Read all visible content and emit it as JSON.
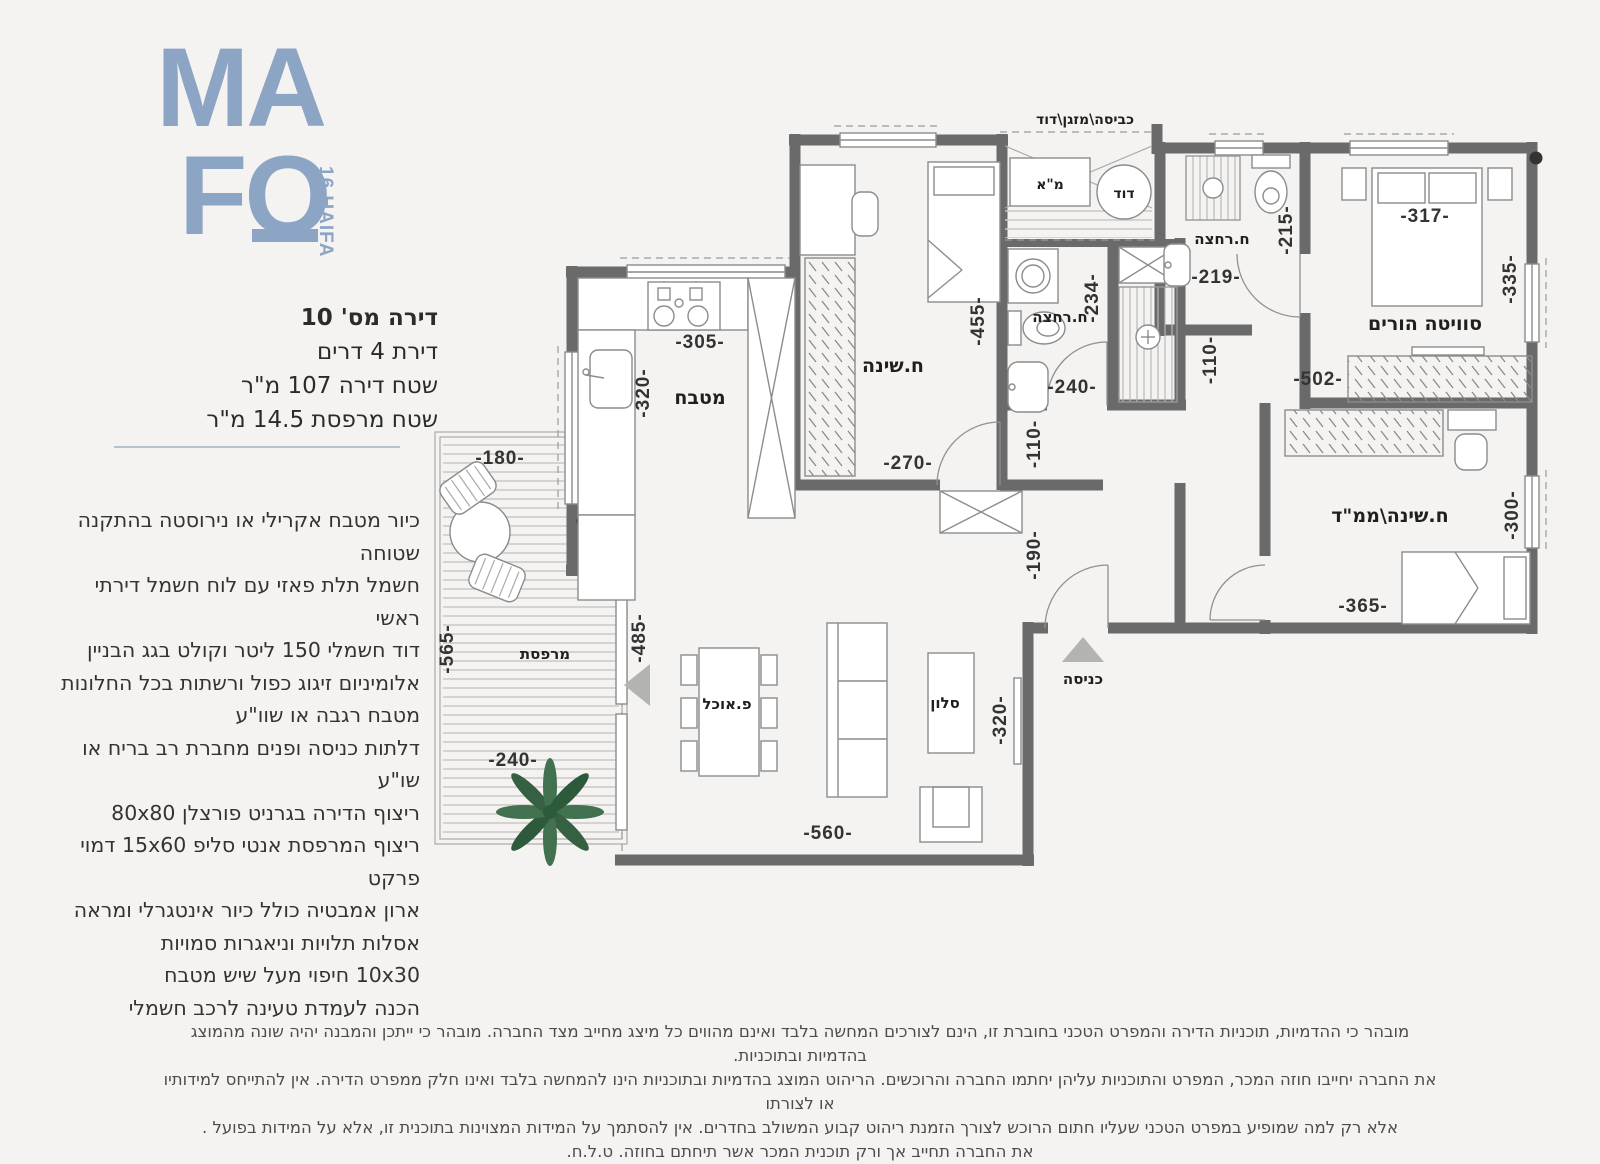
{
  "logo": {
    "line1": "MA",
    "line2": "FO",
    "tag": "16 HAIFA",
    "color": "#8da5c4"
  },
  "apartment": {
    "title": "דירה מס' 10",
    "line2": "דירת 4 דרים",
    "line3": "שטח דירה  107 מ\"ר",
    "line4": "שטח מרפסת 14.5 מ\"ר"
  },
  "specs": {
    "lines": [
      "כיור מטבח אקרילי או נירוסטה בהתקנה שטוחה",
      "חשמל תלת פאזי עם לוח חשמל דירתי ראשי",
      "דוד חשמלי 150 ליטר וקולט בגג הבניין",
      "אלומיניום זיגוג כפול ורשתות בכל החלונות",
      "מטבח רגבה או שוו\"ע",
      "דלתות כניסה ופנים מחברת רב בריח או שו\"ע",
      "ריצוף הדירה בגרניט פורצלן 80x80",
      "ריצוף המרפסת אנטי סליפ 15x60 דמוי פרקט",
      "ארון אמבטיה כולל כיור אינטגרלי ומראה",
      "אסלות תלויות וניאגרות סמויות",
      "10x30 חיפוי מעל שיש מטבח",
      "הכנה לעמדת טעינה לרכב חשמלי"
    ]
  },
  "plan": {
    "rooms": {
      "kitchen": "מטבח",
      "bedroom": "ח.שינה",
      "bath1": "ח.רחצה",
      "bath2": "ח.רחצה",
      "master": "סוויטה הורים",
      "mamad": "ח.שינה\\ממ\"ד",
      "salon": "סלון",
      "dining": "פ.אוכל",
      "balcony": "מרפסת",
      "entrance": "כניסה",
      "service": "כביסה\\מזגן\\דוד",
      "ma": "מ\"א",
      "dud": "דוד"
    },
    "dims": {
      "kitchen_w": "-305-",
      "kitchen_h": "-320-",
      "balcony_top": "-180-",
      "balcony_h": "-565-",
      "balcony_w": "-240-",
      "living_left": "-485-",
      "living_w": "-560-",
      "living_h": "-320-",
      "bedroom_h": "-455-",
      "bedroom_w": "-270-",
      "pass_bedroom": "-110-",
      "foyer_h": "-190-",
      "bath1_h": "-234-",
      "bath1_w": "-240-",
      "hall_w": "-110-",
      "bath2_w": "-219-",
      "bath2_h": "-215-",
      "master_w": "-317-",
      "master_h": "-335-",
      "master_closet": "-502-",
      "mamad_h": "-300-",
      "mamad_w": "-365-"
    }
  },
  "disclaimer": {
    "lines": [
      "מובהר כי ההדמיות, תוכניות הדירה והמפרט הטכני בחוברת זו, הינם לצורכים המחשה בלבד ואינם מהווים כל מיצג מחייב מצד החברה.  מובהר כי ייתכן והמבנה יהיה שונה מהמוצג בהדמיות ובתוכניות.",
      "את החברה יחייבו חוזה המכר, המפרט והתוכניות עליהן יחתמו החברה והרוכשים. הריהוט המוצג בהדמיות ובתוכניות הינו להמחשה בלבד ואינו חלק ממפרט הדירה. אין להתייחס למידותיו או לצורתו",
      "אלא רק למה שמופיע במפרט הטכני שעליו חתום הרוכש לצורך הזמנת ריהוט קבוע המשולב בחדרים. אין להסתמך על המידות המצוינות בתוכנית זו, אלא על המידות בפועל .",
      "את החברה תחייב אך ורק תוכנית המכר אשר תיחתם בחוזה. ט.ל.ח."
    ]
  },
  "colors": {
    "background": "#f4f3f1",
    "wall": "#6a6a6a",
    "accent": "#8da5c4",
    "divider": "#b7c2d1"
  }
}
